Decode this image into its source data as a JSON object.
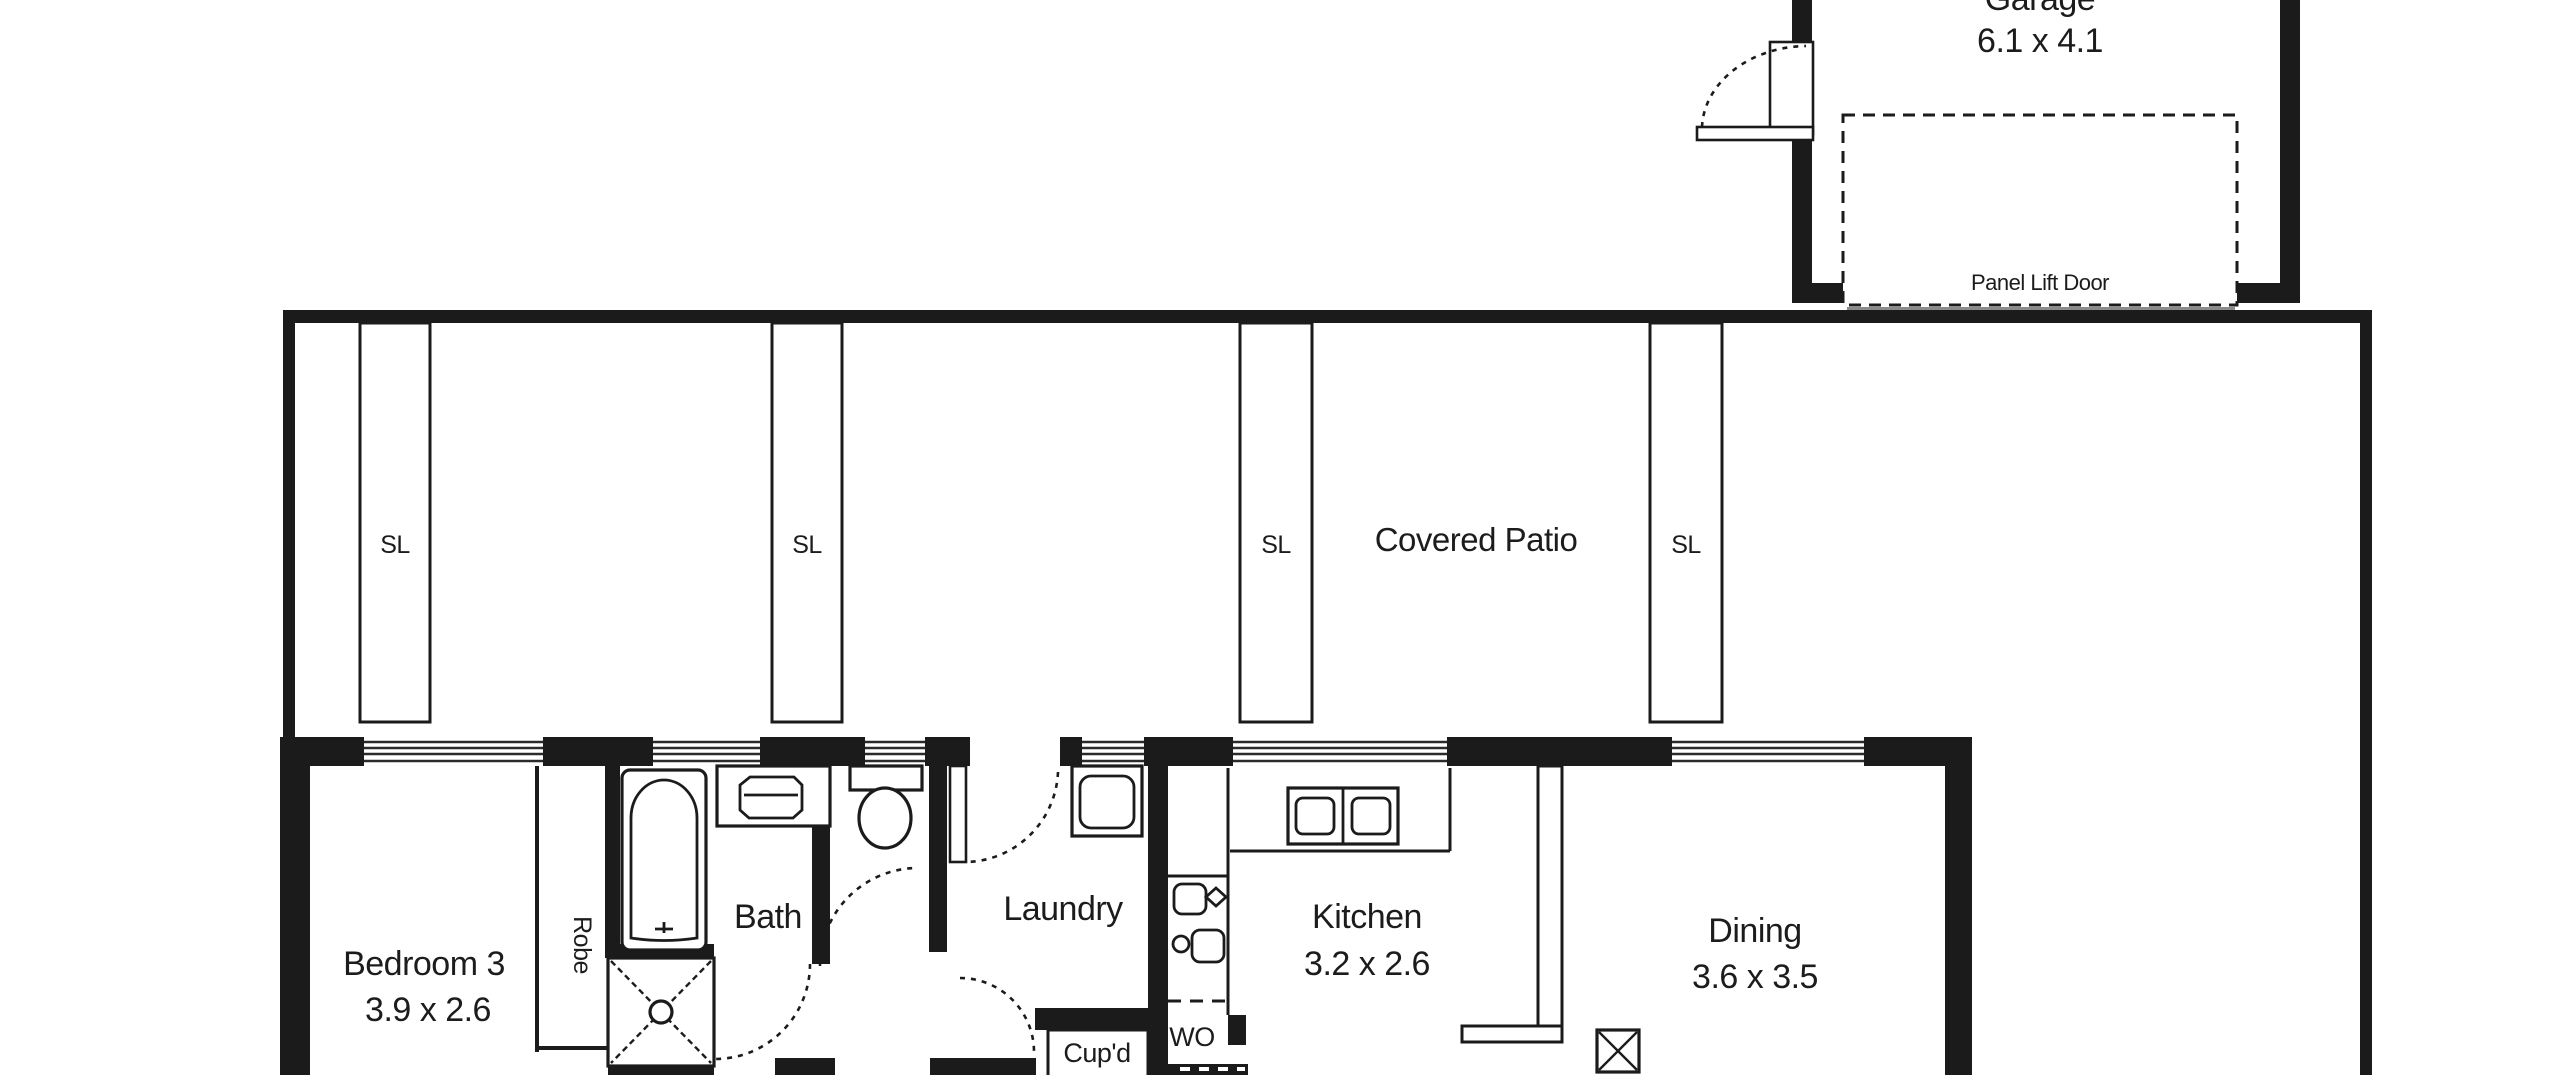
{
  "garage": {
    "label": "Garage",
    "dims": "6.1 x 4.1",
    "panel_door_label": "Panel Lift Door"
  },
  "patio": {
    "label": "Covered Patio",
    "post_label": "SL"
  },
  "rooms": {
    "bedroom3": {
      "label": "Bedroom 3",
      "dims": "3.9 x 2.6"
    },
    "robe": {
      "label": "Robe"
    },
    "bath": {
      "label": "Bath"
    },
    "laundry": {
      "label": "Laundry"
    },
    "cupboard": {
      "label": "Cup'd"
    },
    "wall_oven": {
      "label": "WO"
    },
    "kitchen": {
      "label": "Kitchen",
      "dims": "3.2 x 2.6"
    },
    "dining": {
      "label": "Dining",
      "dims": "3.6 x 3.5"
    }
  },
  "colors": {
    "ink": "#1b1b1b",
    "paper": "#ffffff"
  }
}
